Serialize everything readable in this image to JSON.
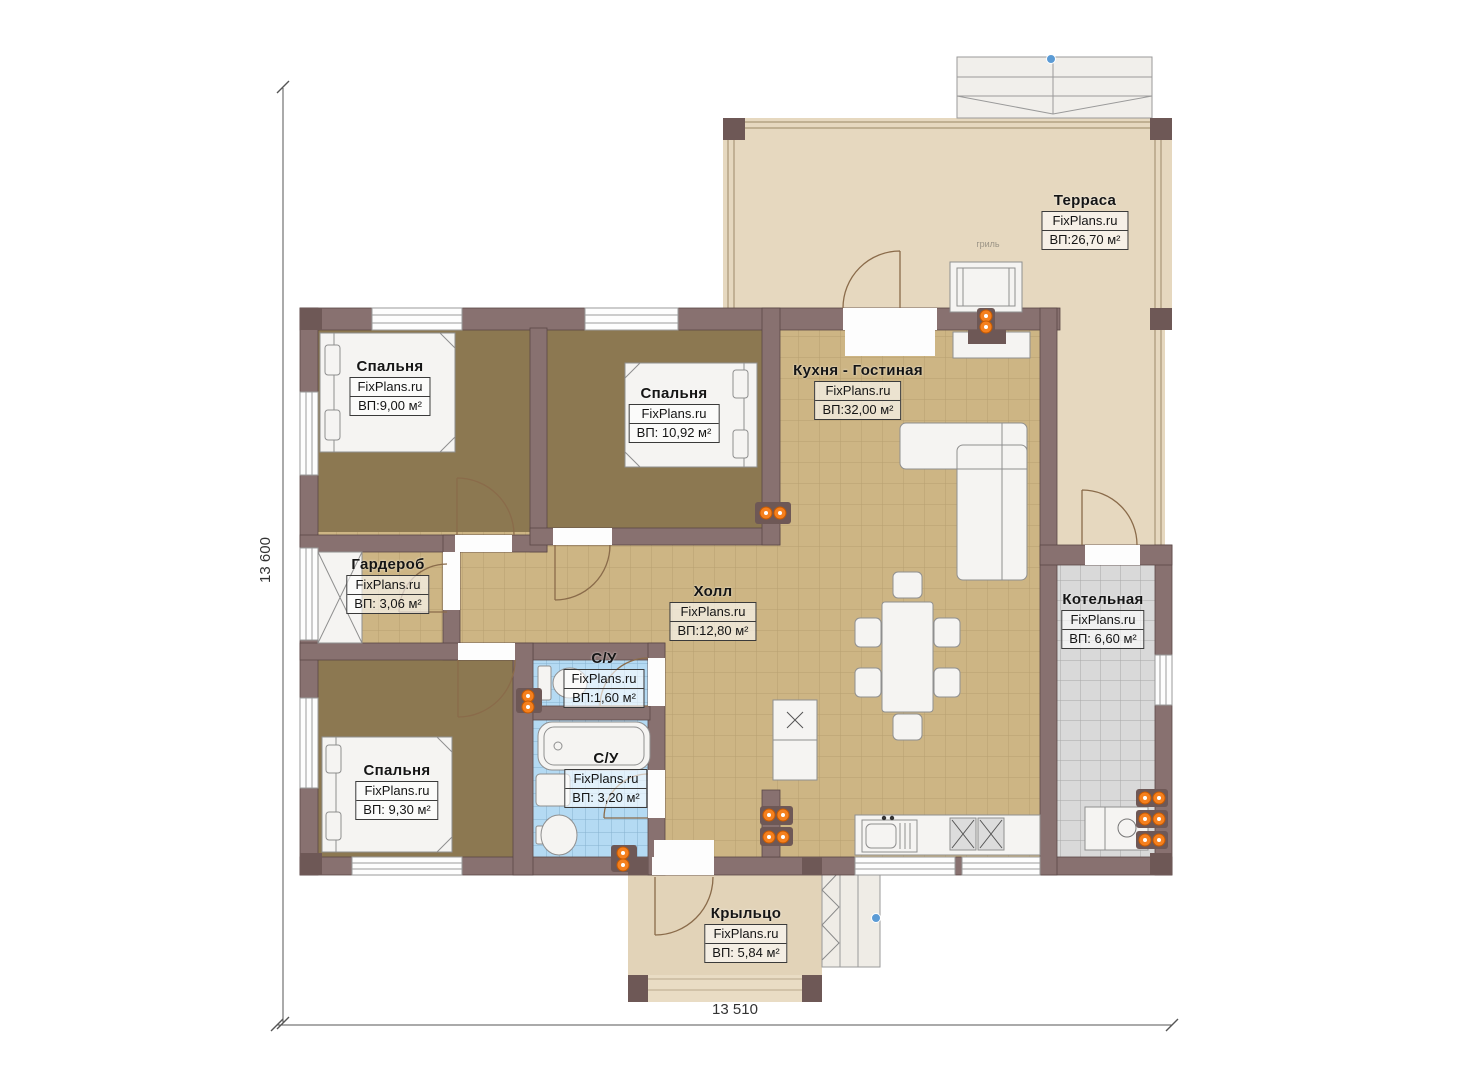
{
  "watermark": "FixPlans.ru",
  "dimensions": {
    "height_total": "13 600",
    "width_total": "13 510"
  },
  "annotations": {
    "grill": "гриль"
  },
  "rooms": [
    {
      "id": "bedroom-top-left",
      "name": "Спальня",
      "watermark": "FixPlans.ru",
      "area": "ВП:9,00 м²"
    },
    {
      "id": "bedroom-top-middle",
      "name": "Спальня",
      "watermark": "FixPlans.ru",
      "area": "ВП: 10,92 м²"
    },
    {
      "id": "kitchen-living",
      "name": "Кухня - Гостиная",
      "watermark": "FixPlans.ru",
      "area": "ВП:32,00 м²"
    },
    {
      "id": "terrace",
      "name": "Терраса",
      "watermark": "FixPlans.ru",
      "area": "ВП:26,70 м²"
    },
    {
      "id": "wardrobe",
      "name": "Гардероб",
      "watermark": "FixPlans.ru",
      "area": "ВП: 3,06 м²"
    },
    {
      "id": "hall",
      "name": "Холл",
      "watermark": "FixPlans.ru",
      "area": "ВП:12,80 м²"
    },
    {
      "id": "boiler-room",
      "name": "Котельная",
      "watermark": "FixPlans.ru",
      "area": "ВП: 6,60 м²"
    },
    {
      "id": "wc-small",
      "name": "С/У",
      "watermark": "FixPlans.ru",
      "area": "ВП:1,60 м²"
    },
    {
      "id": "wc-big",
      "name": "С/У",
      "watermark": "FixPlans.ru",
      "area": "ВП: 3,20 м²"
    },
    {
      "id": "bedroom-bottom",
      "name": "Спальня",
      "watermark": "FixPlans.ru",
      "area": "ВП: 9,30 м²"
    },
    {
      "id": "porch",
      "name": "Крыльцо",
      "watermark": "FixPlans.ru",
      "area": "ВП: 5,84 м²"
    }
  ],
  "colors": {
    "wall": "#887170",
    "wall_dark": "#6e5856",
    "floor_tile": "#cdb584",
    "floor_bedroom": "#8c7851",
    "floor_terrace": "#e6d8bf",
    "bath_tile": "#b4daf3",
    "boiler_tile": "#d9d9d9",
    "radiator_orange": "#f5801e",
    "marker_blue": "#5b9bd5"
  }
}
